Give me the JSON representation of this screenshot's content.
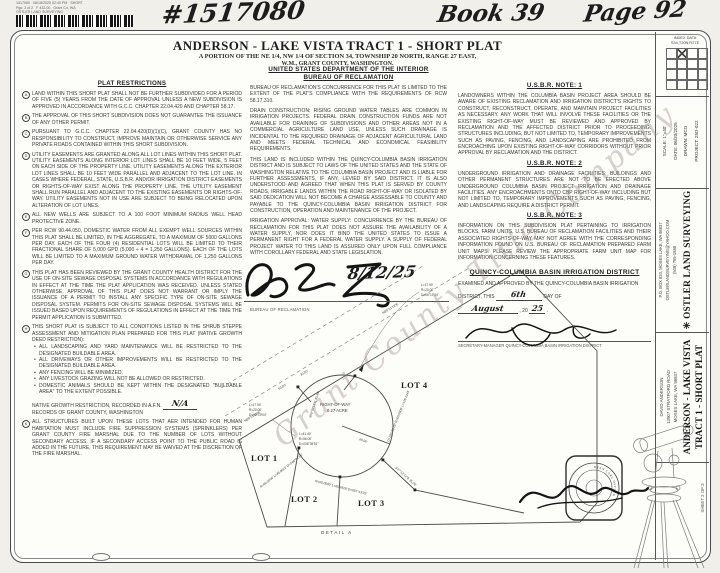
{
  "recording_stamp": {
    "line1": "1517080   08/18/2025 02:40 PM   SHORT",
    "line2": "Pgs: 2 of 2   F 432.00   Grant Co, WA",
    "line3": "OSTLER LAND SURVEYING"
  },
  "handwritten_header": {
    "instrument_number": "#1517080",
    "book": "Book 39",
    "page": "Page 92"
  },
  "title_block": {
    "title": "ANDERSON - LAKE VISTA TRACT 1 - SHORT PLAT",
    "subtitle1": "A PORTION OF THE NE 1/4, NW 1/4 OF SECTION 34, TOWNSHIP 20 NORTH, RANGE 27 EAST,",
    "subtitle2": "W.M., GRANT COUNTY, WASHINGTON."
  },
  "index_box": {
    "label1": "INDEX DATA",
    "label2": "S34,T20N,R27E"
  },
  "plat_restrictions": {
    "heading": "PLAT RESTRICTIONS",
    "items": [
      {
        "letter": "A",
        "text": "LAND WITHIN THIS SHORT PLAT SHALL NOT BE FURTHER SUBDIVIDED FOR A PERIOD OF FIVE (5) YEARS FROM THE DATE OF APPROVAL UNLESS A NEW SUBDIVISION IS APPROVED IN ACCORDANCE WITH G.C.C. CHAPTER 22.04.420 AND CHAPTER 58.17."
      },
      {
        "letter": "B",
        "text": "THE APPROVAL OF THIS SHORT SUBDIVISION DOES NOT GUARANTEE THE ISSUANCE OF ANY OTHER PERMIT."
      },
      {
        "letter": "C",
        "text": "PURSUANT TO G.C.C. CHAPTER 22.04.420(D)(1)(C), GRANT COUNTY HAS NO RESPONSIBILITY TO CONSTRUCT, IMPROVE MAINTAIN OR OTHERWISE SERVICE ANY PRIVATE ROADS CONTAINED WITHIN THIS SHORT SUBDIVISION."
      },
      {
        "letter": "D",
        "text": "UTILITY EASEMENTS ARE GRANTED ALONG ALL LOT LINES WITHIN THIS SHORT PLAT. UTILITY EASEMENTS ALONG INTERIOR LOT LINES SHALL BE 10 FEET WIDE, 5 FEET ON EACH SIDE OF THE PROPERTY LINE. UTILITY EASEMENTS ALONG THE EXTERIOR LOT LINES SHALL BE 10 FEET WIDE PARALLEL AND ADJACENT TO THE LOT LINE. IN CASES WHERE FEDERAL, STATE, U.S.B.R. AND/OR IRRIGATION DISTRICT EASEMENTS OR RIGHTS-OF-WAY EXIST ALONG THE PROPERTY LINE, THE UTILITY EASEMENT SHALL RUN PARALLEL AND ADJACENT TO THE EXISTING EASEMENTS OR RIGHTS-OF-WAY. UTILITY EASEMENTS NOT IN USE ARE SUBJECT TO BEING RELOCATED UPON ALTERATION OF LOT LINES."
      },
      {
        "letter": "E",
        "text": "ALL NEW WELLS ARE SUBJECT TO A 100 FOOT MINIMUM RADIUS WELL HEAD PROTECTIVE ZONE."
      },
      {
        "letter": "F",
        "text": "PER RCW 90.44.050, DOMESTIC WATER FROM ALL EXEMPT WELL SOURCES WITHIN THIS PLAT SHALL BE LIMITED, IN THE AGGREGATE, TO A MAXIMUM OF 5000 GALLONS PER DAY. EACH OF THE FOUR (4) RESIDENTIAL LOTS WILL BE LIMITED TO THEIR FRACTIONAL SHARE OF 5,000 GPD (5,000 ÷ 4 = 1,250 GALLONS). EACH OF THE LOTS WILL BE LIMITED TO A MAXIMUM GROUND WATER WITHDRAWAL OF 1,250 GALLONS PER DAY."
      },
      {
        "letter": "G",
        "text": "THIS PLAT HAS BEEN REVIEWED BY THE GRANT COUNTY HEALTH DISTRICT FOR THE USE OF ON-SITE SEWAGE DISPOSAL SYSTEMS IN ACCORDANCE WITH REGULATIONS IN EFFECT AT THE TIME THE PLAT APPLICATION WAS RECEIVED. UNLESS STATED OTHERWISE, APPROVAL OF THIS PLAT DOES NOT WARRANT OR IMPLY THE ISSUANCE OF A PERMIT TO INSTALL ANY SPECIFIC TYPE OF ON-SITE SEWAGE DISPOSAL SYSTEM. PERMITS FOR ON-SITE SEWAGE DISPOSAL SYSTEMS WILL BE ISSUED BASED UPON REQUIREMENTS OF REGULATIONS IN EFFECT AT THE TIME THE PERMIT APPLICATION IS SUBMITTED."
      },
      {
        "letter": "H",
        "text": "THIS SHORT PLAT IS SUBJECT TO ALL CONDITIONS LISTED IN THE SHRUB STEPPE ASSESSMENT AND MITIGATION PLAN PREPARED FOR THIS PLAT (NATIVE GROWTH DEED RESTRICTION):",
        "bullets": [
          "ALL LANDSCAPING AND YARD MAINTENANCE WILL BE RESTRICTED TO THE DESIGNATED BUILDABLE AREA.",
          "ALL DRIVEWAYS OR OTHER IMPROVEMENTS WILL BE RESTRICTED TO THE DESIGNATED BUILDABLE AREA.",
          "ANY FENCING WILL BE MINIMIZED.",
          "ANY LIVESTOCK GRAZING WILL NOT BE ALLOWED OR RESTRICTED.",
          "DOMESTIC ANIMALS SHOULD BE KEPT WITHIN THE DESIGNATED \"BUILDABLE AREA\" TO THE EXTENT POSSIBLE."
        ],
        "afn_line1": "NATIVE GROWTH RESTRICTION, RECORDED IN A.F.N.",
        "afn_value": "N/A",
        "afn_line2": "RECORDS OF GRANT COUNTY, WASHINGTON"
      },
      {
        "letter": "K",
        "text": "ALL STRUCTURES BUILT UPON THESE LOTS THAT AER INTENDED FOR HUMAN HABITATION MUST INCLUDE FIRE SUPPRESSION SYSTEMS (SPRINKLERS) PER GRANT COUNTY FIRE MARSHAL DUE TO THE NUMBER OF LOTS WITHOUT SECONDARY ACCESS. IF A SECONDARY ACCESS POINT TO THE PUBLIC ROAD IS ADDED IN THE FUTURE, THIS REQUIREMENT MAY BE WAIVED AT THE DISCRETION OF THE FIRE MARSHAL."
      }
    ]
  },
  "bureau_section": {
    "heading1": "UNITED STATES DEPARTMENT OF THE INTERIOR",
    "heading2": "BUREAU OF RECLAMATION",
    "paragraphs": [
      "BUREAU OF RECLAMATION'S CONCURRENCE FOR THIS PLAT IS LIMITED TO THE EXTENT OF THE PLAT'S COMPLIANCE WITH THE REQUIREMENTS OF RCW 58.17.310.",
      "DRAIN CONSTRUCTION:  RISING GROUND WATER TABLES ARE COMMON IN IRRIGATION PROJECTS. FEDERAL DRAIN CONSTRUCTION FUNDS ARE NOT AVAILABLE FOR DRAINING OF SUBDIVISIONS AND OTHER AREAS NOT IN A COMMERCIAL AGRICULTURE LAND USE, UNLESS SUCH DRAINAGE IS INCIDENTAL TO THE REQUIRED DRAINAGE OF ADJACENT AGRICULTURAL LAND AND MEETS FEDERAL TECHNICAL AND ECONOMICAL FEASIBILITY REQUIREMENTS.",
      "THIS LAND IS INCLUDED WITHIN THE QUINCY-COLUMBIA BASIN IRRIGATION DISTRICT AND IS SUBJECT TO LAWS OF THE UNITED STATES AND THE STATE OF WASHINGTON RELATIVE TO THE COLUMBIA BASIN PROJECT AND IS LIABLE FOR FURTHER ASSESSMENTS, IF ANY, LEVIED BY SAID DISTRICT. IT IS ALSO UNDERSTOOD AND AGREED THAT WHEN THIS PLAT IS SERVED BY COUNTY ROADS, IRRIGABLE LANDS WITHIN THE ROAD RIGHT-OF-WAY OR ISOLATED BY SAID DEDICATION WILL NOT BECOME A CHARGE ASSESSABLE TO COUNTY AND PAYABLE TO THE QUINCY-COLUMBIA BASIN IRRIGATION DISTRICT FOR CONSTRUCTION, OPERATION AND MAINTENANCE OF THE PROJECT.",
      "IRRIGATION APPROVAL: WATER SUPPLY: CONCURRENCE BY THE BUREAU OF RECLAMATION FOR THIS PLAT DOES NOT ASSURE THE AVAILABILITY OF A WATER SUPPLY, NOR DOES IT BIND THE UNITED STATES TO ISSUE A PERMANENT RIGHT FOR A FEDERAL WATER SUPPLY.  A SUPPLY OF FEDERAL PROJECT WATER TO THIS LAND IS ASSURED ONLY UPON FULL COMPLIANCE WITH COROLLARY FEDERAL AND STATE LEGISLATION."
    ],
    "signature_date": "8/12/25",
    "signature_caption": "BUREAU OF RECLAMATION"
  },
  "usbr_notes": {
    "note1_heading": "U.S.B.R. NOTE: 1",
    "note1_text": "LANDOWNERS WITHIN THE COLUMBIA BASIN PROJECT AREA SHOULD BE AWARE OF EXISTING RECLAMATION AND IRRIGATION DISTRICT'S RIGHTS TO CONSTRUCT, RECONSTRUCT, OPERATE, AND MAINTAIN PROJECT FACILITIES AS NECESSARY. ANY WORK THAT WILL INVOLVE THESE FACILITIES OR THE EXISTING RIGHT-OF-WAY MUST BE REVIEWED AND APPROVED BY RECLAMATION AND THE AFFECTED DISTRICT PRIOR TO PROCEEDING. STRUCTURES INCLUDING, BUT NOT LIMITED TO, TEMPORARY IMPROVEMENTS SUCH AS PAVING, FENCING, AND LANDSCAPING ARE PROHIBITED FROM ENCROACHING UPON EXISTING RIGHT-OF-WAY CORRIDORS WITHOUT PRIOR APPROVAL BY RECLAMATION AND THE DISTRICT.",
    "note2_heading": "U.S.B.R. NOTE: 2",
    "note2_text": "UNDERGROUND IRRIGATION AND DRAINAGE FACILITIES: BUILDINGS AND OTHER PERMANENT STRUCTURES ARE NOT TO BE ERECTED ABOVE UNDERGROUND COLUMBIA BASIN PROJECT IRRIGATION AND DRAINAGE FACILITIES.  ANY ENCROACHMENTS ONTO CBP RIGHT-OF-WAY INCLUDING BUT NOT LIMITED TO, TEMPORARY IMPROVEMENTS SUCH AS PAVING, FENCING, AND LANDSCAPING REQUIRE A DISTRICT PERMIT.",
    "note3_heading": "U.S.B.R. NOTE: 3",
    "note3_text": "INFORMATION ON THIS SUBDIVISION PLAT PERTAINING TO IRRIGATION BLOCKS, FARM UNITS, U.S. BUREAU OF RECLAMATION FACILITIES AND THEIR ASSOCIATED RIGHTS-OF-WAY MAY NOT AGREE WITH THE CORRESPONDING INFORMATION FOUND ON U.S. BUREAU OF RECLAMATION PREPARED FARM UNIT MAPS. PLEASE REVIEW THE APPROPRIATE FARM UNIT MAP FOR INFORMATION CONCERNING THESE FEATURES."
  },
  "district_approval": {
    "heading": "QUINCY-COLUMBIA BASIN IRRIGATION DISTRICT",
    "body1": "EXAMINED AND APPROVED BY THE QUINCY-COLUMBIA BASIN IRRIGATION",
    "body2": "DISTRICT, THIS",
    "day": "6th",
    "body3": "DAY OF",
    "month": "August",
    "body4": ", 20",
    "year": "25",
    "body5": ".",
    "signature_caption": "SECRETARY-MANAGER QUINCY-COLUMBIA BASIN IRRIGATION DISTRICT"
  },
  "plat_map": {
    "caption": "DETAIL A",
    "lot1": "LOT 1",
    "lot2": "LOT 2",
    "lot3": "LOT 3",
    "lot4": "LOT 4",
    "row_label1": "RIGHT-OF-WAY",
    "row_label2": "0.27 ACRE",
    "radius_label": "60.00'",
    "bearing_main": "N89°51'12\"E",
    "bearing_main2": "N89°51'12\"E",
    "dim_50": "50.00'",
    "dim_30": "30.00'",
    "c1a": "L=17.90'",
    "c1b": "R=20.00'",
    "c1c": "D=05°19'04\"",
    "c2a": "L=41.40'",
    "c2b": "R=56.00'",
    "c2c": "D=036°35'51\"",
    "c3": "R=60.0000'  L=60.4828'  D=057°43'25\"",
    "c4": "D=120°33'18\"  R=60.0000'  L=126.2443'",
    "c5": "R=60.0000'  L=48.9520'  D=046°44'15\"",
    "b1": "S47°12'14\"E  35.00'",
    "b2": "S09°09'16\"E  43.46'"
  },
  "surveyor_panel": {
    "scale": "SCALE: 1\"=40'",
    "date": "DATE: 06/20/2025",
    "drawn": "DRAWN: MCO",
    "project": "PROJECT: 25D-022",
    "company": "OSTLER LAND SURVEYING",
    "address": "P.O. BOX 820, MOSES LAKE, WA 98837",
    "email": "OSTLERLANDSURVEYING@YAHOO.COM",
    "phone": "(509) 765-1588",
    "client1": "DAVID ANDERSON",
    "client2": "13907 STRATFORD ROAD",
    "client3": "MOSES LAKE, WA 98837",
    "plat_title1": "ANDERSON - LAKE VISTA",
    "plat_title2": "TRACT 1 - SHORT PLAT",
    "sheet": "SHEET 2 OF 3"
  },
  "seal": {
    "ring_text": "RYAN CARL OSTLER"
  },
  "watermark": "Grant County Title Company"
}
